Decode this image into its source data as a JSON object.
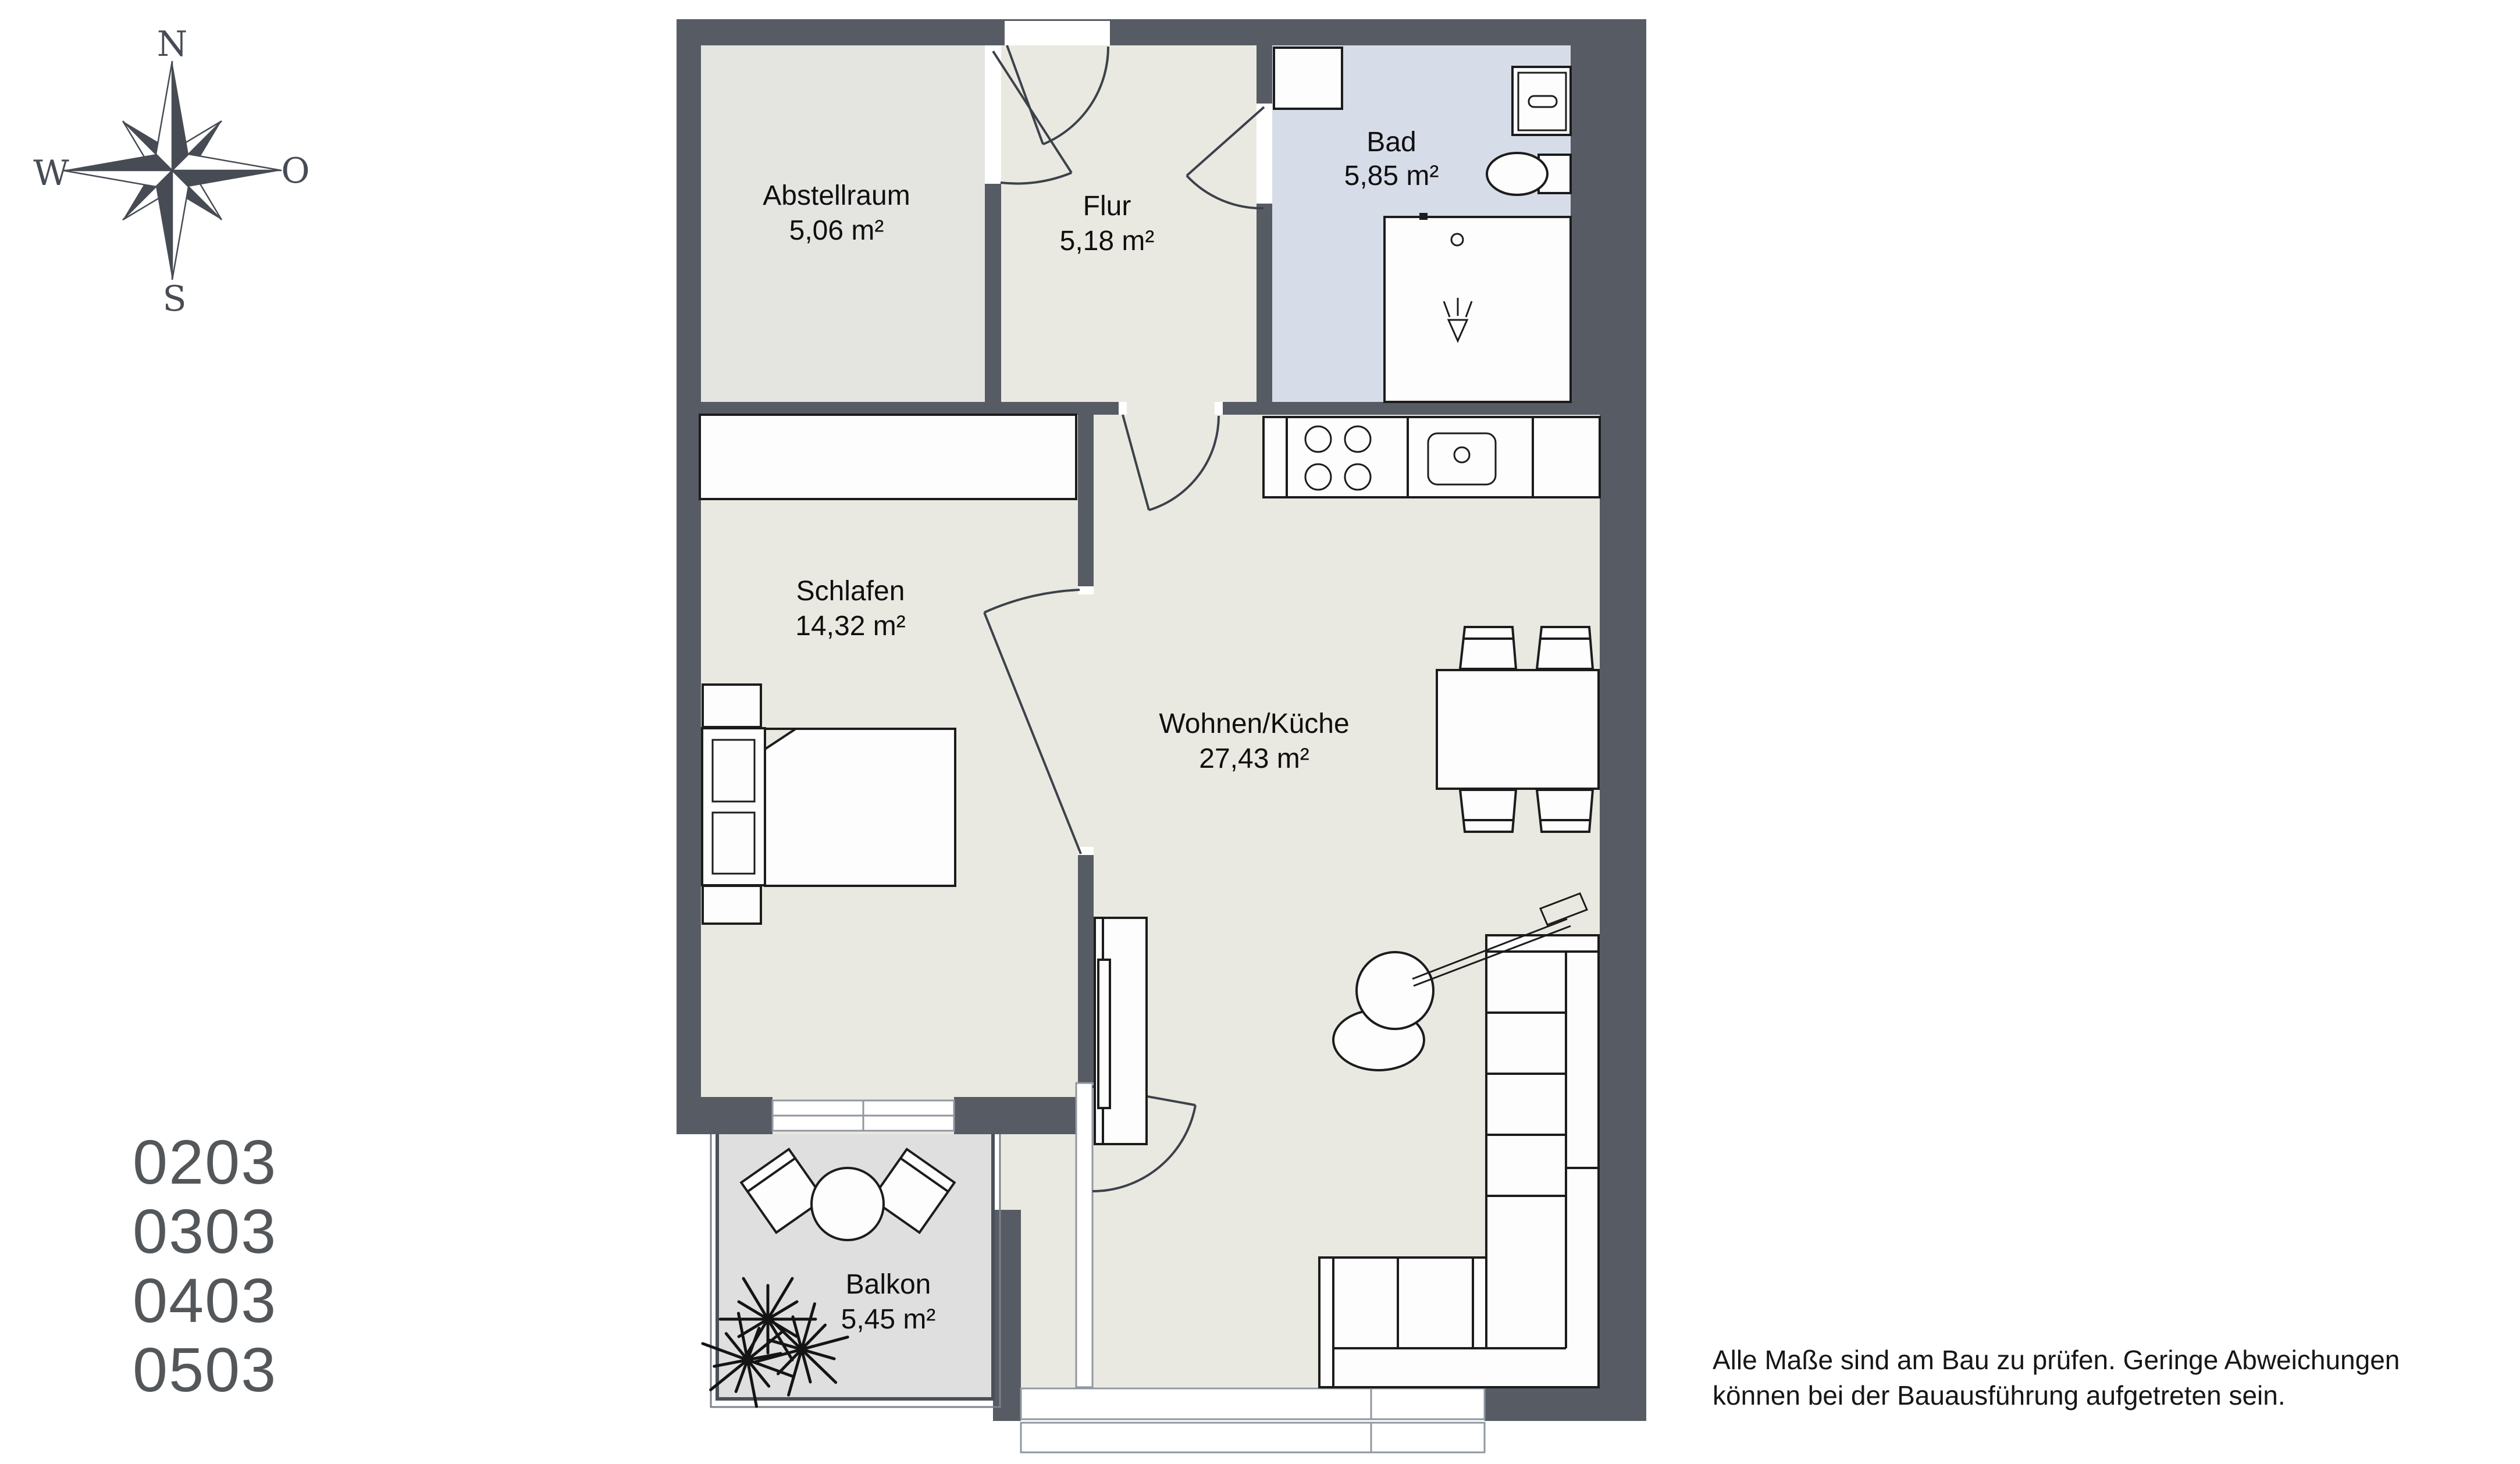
{
  "compass": {
    "n": "N",
    "e": "O",
    "s": "S",
    "w": "W"
  },
  "rooms": [
    {
      "id": "abstellraum",
      "name": "Abstellraum",
      "area": "5,06 m²"
    },
    {
      "id": "flur",
      "name": "Flur",
      "area": "5,18 m²"
    },
    {
      "id": "bad",
      "name": "Bad",
      "area": "5,85 m²"
    },
    {
      "id": "schlafen",
      "name": "Schlafen",
      "area": "14,32 m²"
    },
    {
      "id": "wohnen",
      "name": "Wohnen/Küche",
      "area": "27,43 m²"
    },
    {
      "id": "balkon",
      "name": "Balkon",
      "area": "5,45 m²"
    }
  ],
  "units": [
    "0203",
    "0303",
    "0403",
    "0503"
  ],
  "disclaimer": {
    "line1": "Alle Maße sind am Bau zu prüfen. Geringe Abweichungen",
    "line2": "können bei der Bauausführung aufgetreten sein."
  },
  "colors": {
    "wall": "#575c64",
    "floor": "#eae9e1",
    "abstell": "#e4e4e1",
    "bad": "#d6dde8",
    "balkon": "#dfdfdf",
    "outline": "#1c1c1c",
    "compass": "#474c54"
  }
}
